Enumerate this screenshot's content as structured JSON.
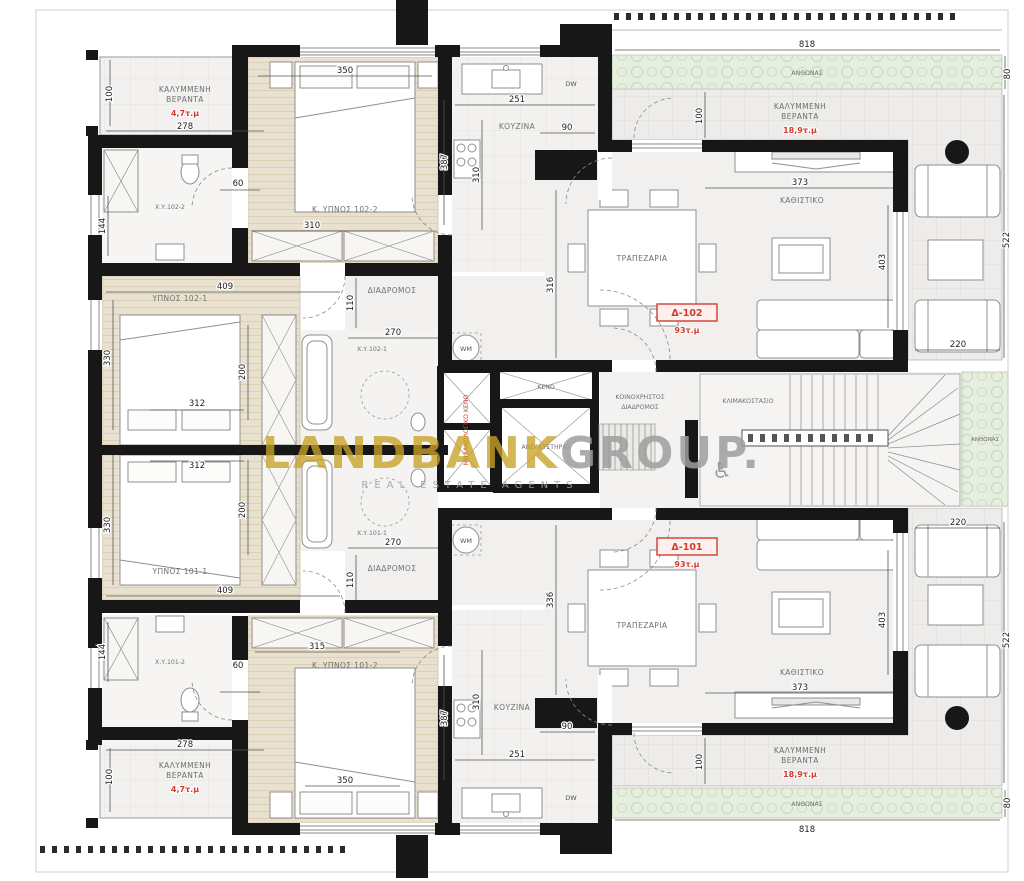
{
  "watermark": {
    "brand": "LANDBANK",
    "brand2": "GROUP.",
    "tagline": "REAL ESTATE AGENTS"
  },
  "colors": {
    "accent_red": "#d23b2e",
    "watermark_gold": "#c9a227",
    "planter_green": "#e6eedf",
    "wall_black": "#171717",
    "bedroom_beige": "#e9e1cf"
  },
  "core": {
    "void": "ΚΕΝΟ",
    "elevator": "ΑΝΕΛΚΥΣΤΗΡΑΣ",
    "corridor1": "ΚΟΙΝΟΧΡΗΣΤΟΣ",
    "corridor2": "ΔΙΑΔΡΟΜΟΣ",
    "stairwell": "ΚΛΙΜΑΚΟΣΤΑΣΙΟ",
    "shaft_note": "ΜΗΧΑΝΟΛΟΓΙΚΟ ΚΕΝΟ",
    "accessible_icon": "♿"
  },
  "planters": {
    "top": "ΑΝΘΩΝΑΣ",
    "right": "ΑΝΘΩΝΑΣ",
    "bottom": "ΑΝΘΩΝΑΣ"
  },
  "apt_top": {
    "unit": "Δ-102",
    "unit_area": "93τ.μ",
    "veranda_small": {
      "l1": "ΚΑΛΥΜΜΕΝΗ",
      "l2": "ΒΕΡΑΝΤΑ",
      "area": "4,7τ.μ",
      "dim_w": "278",
      "dim_d": "100"
    },
    "bath2": {
      "label": "Χ.Υ.102-2",
      "dim_door": "60",
      "dim_shower": "144"
    },
    "bed2": {
      "label": "Κ. ΥΠΝΟΣ 102-2",
      "dim_w": "350",
      "dim_w2": "310",
      "dim_h": "387"
    },
    "kitchen": {
      "label": "ΚΟΥΖΙΝΑ",
      "dw": "DW",
      "dim_w": "251",
      "dim_pass": "90",
      "dim_h": "310"
    },
    "corridor": {
      "label": "ΔΙΑΔΡΟΜΟΣ",
      "dim_w": "270",
      "dim_h": "110"
    },
    "bath1": {
      "label": "Χ.Υ.102-1",
      "wm": "WM"
    },
    "bed1": {
      "label": "ΥΠΝΟΣ 102-1",
      "dim_w": "409",
      "dim_h": "330",
      "dim_ward": "200",
      "dim_bed": "312"
    },
    "dining": {
      "label": "ΤΡΑΠΕΖΑΡΙΑ",
      "dim_h": "316"
    },
    "living": {
      "label": "ΚΑΘΙΣΤΙΚΟ",
      "dim_w": "373",
      "dim_h": "403"
    },
    "veranda_big": {
      "l1": "ΚΑΛΥΜΜΕΝΗ",
      "l2": "ΒΕΡΑΝΤΑ",
      "area": "18,9τ.μ",
      "dim_d": "100",
      "dim_h": "522",
      "dim_w2": "220"
    },
    "planter": {
      "dim_w": "818",
      "dim_d": "80"
    }
  },
  "apt_bottom": {
    "unit": "Δ-101",
    "unit_area": "93τ.μ",
    "veranda_small": {
      "l1": "ΚΑΛΥΜΜΕΝΗ",
      "l2": "ΒΕΡΑΝΤΑ",
      "area": "4,7τ.μ",
      "dim_w": "278",
      "dim_d": "100"
    },
    "bath2": {
      "label": "Χ.Υ.101-2",
      "dim_door": "60",
      "dim_shower": "144"
    },
    "bed2": {
      "label": "Κ. ΥΠΝΟΣ 101-2",
      "dim_w": "350",
      "dim_w2": "315",
      "dim_h": "387"
    },
    "kitchen": {
      "label": "ΚΟΥΖΙΝΑ",
      "dw": "DW",
      "dim_w": "251",
      "dim_pass": "90",
      "dim_h": "310"
    },
    "corridor": {
      "label": "ΔΙΑΔΡΟΜΟΣ",
      "dim_w": "270",
      "dim_h": "110"
    },
    "bath1": {
      "label": "Χ.Υ.101-1",
      "wm": "WM"
    },
    "bed1": {
      "label": "ΥΠΝΟΣ 101-1",
      "dim_w": "409",
      "dim_h": "330",
      "dim_ward": "200",
      "dim_bed": "312"
    },
    "dining": {
      "label": "ΤΡΑΠΕΖΑΡΙΑ",
      "dim_h": "336"
    },
    "living": {
      "label": "ΚΑΘΙΣΤΙΚΟ",
      "dim_w": "373",
      "dim_h": "403"
    },
    "veranda_big": {
      "l1": "ΚΑΛΥΜΜΕΝΗ",
      "l2": "ΒΕΡΑΝΤΑ",
      "area": "18,9τ.μ",
      "dim_d": "100",
      "dim_h": "522",
      "dim_w2": "220"
    },
    "planter": {
      "dim_w": "818",
      "dim_d": "80"
    }
  }
}
